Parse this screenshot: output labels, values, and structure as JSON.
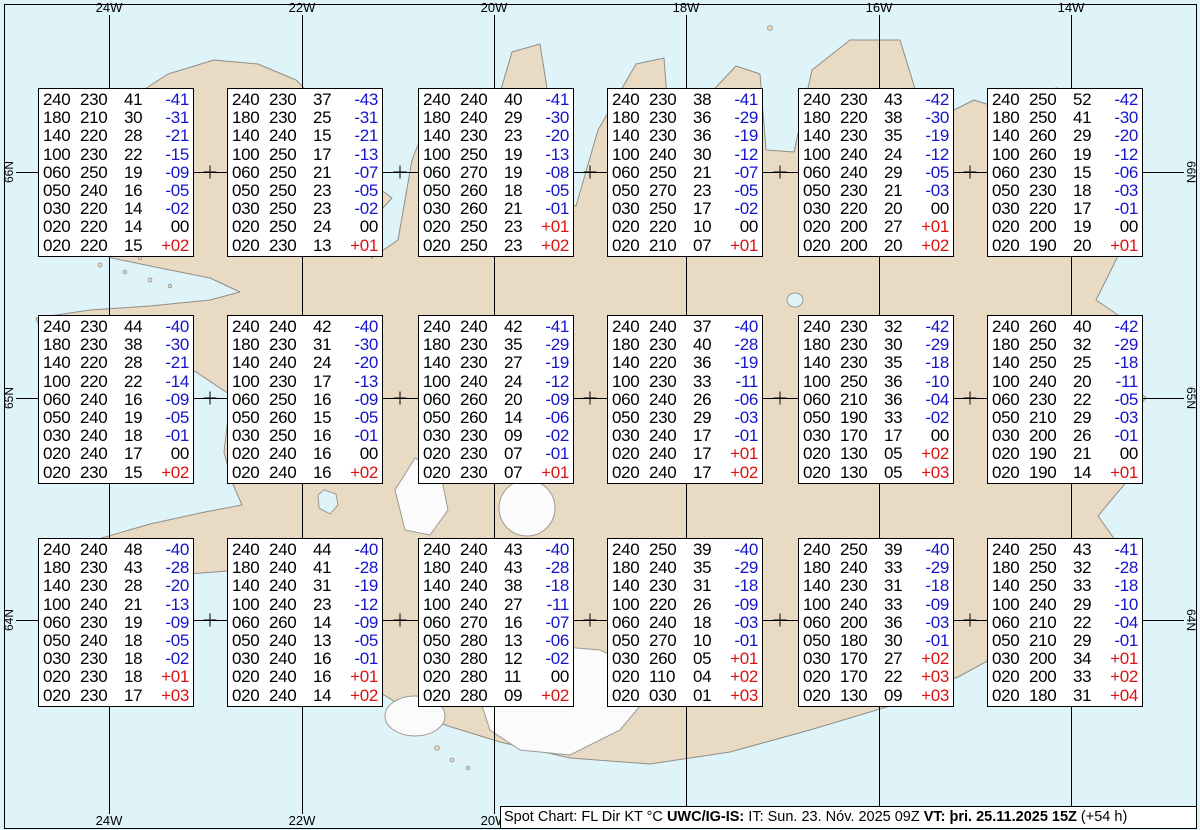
{
  "map": {
    "top_labels": [
      "24W",
      "22W",
      "20W",
      "18W",
      "16W",
      "14W"
    ],
    "bottom_labels": [
      "24W",
      "22W",
      "20W",
      "18W",
      "16W",
      "14W"
    ],
    "left_labels": [
      "66N",
      "65N",
      "64N"
    ],
    "right_labels": [
      "66N",
      "65N",
      "64N"
    ]
  },
  "colors": {
    "sea": "#dff4f9",
    "land": "#e9dac4",
    "coastline": "#8f8f88",
    "glacier": "#fbfbfb",
    "grid": "#000000",
    "box_background": "#ffffff",
    "temp_negative": "#1414cc",
    "temp_positive": "#dd1111",
    "text": "#000000"
  },
  "spots": [
    {
      "rows": [
        [
          "240",
          "230",
          "41",
          "-41"
        ],
        [
          "180",
          "210",
          "30",
          "-31"
        ],
        [
          "140",
          "220",
          "28",
          "-21"
        ],
        [
          "100",
          "230",
          "22",
          "-15"
        ],
        [
          "060",
          "250",
          "19",
          "-09"
        ],
        [
          "050",
          "240",
          "16",
          "-05"
        ],
        [
          "030",
          "220",
          "14",
          "-02"
        ],
        [
          "020",
          "220",
          "14",
          "00"
        ],
        [
          "020",
          "220",
          "15",
          "+02"
        ]
      ]
    },
    {
      "rows": [
        [
          "240",
          "230",
          "37",
          "-43"
        ],
        [
          "180",
          "230",
          "25",
          "-31"
        ],
        [
          "140",
          "240",
          "15",
          "-21"
        ],
        [
          "100",
          "250",
          "17",
          "-13"
        ],
        [
          "060",
          "250",
          "21",
          "-07"
        ],
        [
          "050",
          "250",
          "23",
          "-05"
        ],
        [
          "030",
          "250",
          "23",
          "-02"
        ],
        [
          "020",
          "250",
          "24",
          "00"
        ],
        [
          "020",
          "230",
          "13",
          "+01"
        ]
      ]
    },
    {
      "rows": [
        [
          "240",
          "240",
          "40",
          "-41"
        ],
        [
          "180",
          "240",
          "29",
          "-30"
        ],
        [
          "140",
          "230",
          "23",
          "-20"
        ],
        [
          "100",
          "250",
          "19",
          "-13"
        ],
        [
          "060",
          "270",
          "19",
          "-08"
        ],
        [
          "050",
          "260",
          "18",
          "-05"
        ],
        [
          "030",
          "260",
          "21",
          "-01"
        ],
        [
          "020",
          "250",
          "23",
          "+01"
        ],
        [
          "020",
          "250",
          "23",
          "+02"
        ]
      ]
    },
    {
      "rows": [
        [
          "240",
          "230",
          "38",
          "-41"
        ],
        [
          "180",
          "230",
          "36",
          "-29"
        ],
        [
          "140",
          "230",
          "36",
          "-19"
        ],
        [
          "100",
          "240",
          "30",
          "-12"
        ],
        [
          "060",
          "250",
          "21",
          "-07"
        ],
        [
          "050",
          "270",
          "23",
          "-05"
        ],
        [
          "030",
          "250",
          "17",
          "-02"
        ],
        [
          "020",
          "220",
          "10",
          "00"
        ],
        [
          "020",
          "210",
          "07",
          "+01"
        ]
      ]
    },
    {
      "rows": [
        [
          "240",
          "230",
          "43",
          "-42"
        ],
        [
          "180",
          "220",
          "38",
          "-30"
        ],
        [
          "140",
          "230",
          "35",
          "-19"
        ],
        [
          "100",
          "240",
          "24",
          "-12"
        ],
        [
          "060",
          "240",
          "29",
          "-05"
        ],
        [
          "050",
          "230",
          "21",
          "-03"
        ],
        [
          "030",
          "220",
          "20",
          "00"
        ],
        [
          "020",
          "200",
          "27",
          "+01"
        ],
        [
          "020",
          "200",
          "20",
          "+02"
        ]
      ]
    },
    {
      "rows": [
        [
          "240",
          "250",
          "52",
          "-42"
        ],
        [
          "180",
          "250",
          "41",
          "-30"
        ],
        [
          "140",
          "260",
          "29",
          "-20"
        ],
        [
          "100",
          "260",
          "19",
          "-12"
        ],
        [
          "060",
          "230",
          "15",
          "-06"
        ],
        [
          "050",
          "230",
          "18",
          "-03"
        ],
        [
          "030",
          "220",
          "17",
          "-01"
        ],
        [
          "020",
          "200",
          "19",
          "00"
        ],
        [
          "020",
          "190",
          "20",
          "+01"
        ]
      ]
    },
    {
      "rows": [
        [
          "240",
          "230",
          "44",
          "-40"
        ],
        [
          "180",
          "230",
          "38",
          "-30"
        ],
        [
          "140",
          "220",
          "28",
          "-21"
        ],
        [
          "100",
          "220",
          "22",
          "-14"
        ],
        [
          "060",
          "240",
          "16",
          "-09"
        ],
        [
          "050",
          "240",
          "19",
          "-05"
        ],
        [
          "030",
          "240",
          "18",
          "-01"
        ],
        [
          "020",
          "240",
          "17",
          "00"
        ],
        [
          "020",
          "230",
          "15",
          "+02"
        ]
      ]
    },
    {
      "rows": [
        [
          "240",
          "240",
          "42",
          "-40"
        ],
        [
          "180",
          "230",
          "31",
          "-30"
        ],
        [
          "140",
          "240",
          "24",
          "-20"
        ],
        [
          "100",
          "230",
          "17",
          "-13"
        ],
        [
          "060",
          "250",
          "16",
          "-09"
        ],
        [
          "050",
          "260",
          "15",
          "-05"
        ],
        [
          "030",
          "250",
          "16",
          "-01"
        ],
        [
          "020",
          "240",
          "16",
          "00"
        ],
        [
          "020",
          "240",
          "16",
          "+02"
        ]
      ]
    },
    {
      "rows": [
        [
          "240",
          "240",
          "42",
          "-41"
        ],
        [
          "180",
          "230",
          "35",
          "-29"
        ],
        [
          "140",
          "230",
          "27",
          "-19"
        ],
        [
          "100",
          "240",
          "24",
          "-12"
        ],
        [
          "060",
          "260",
          "20",
          "-09"
        ],
        [
          "050",
          "260",
          "14",
          "-06"
        ],
        [
          "030",
          "230",
          "09",
          "-02"
        ],
        [
          "020",
          "230",
          "07",
          "-01"
        ],
        [
          "020",
          "230",
          "07",
          "+01"
        ]
      ]
    },
    {
      "rows": [
        [
          "240",
          "240",
          "37",
          "-40"
        ],
        [
          "180",
          "230",
          "40",
          "-28"
        ],
        [
          "140",
          "220",
          "36",
          "-19"
        ],
        [
          "100",
          "230",
          "33",
          "-11"
        ],
        [
          "060",
          "240",
          "26",
          "-06"
        ],
        [
          "050",
          "230",
          "29",
          "-03"
        ],
        [
          "030",
          "240",
          "17",
          "-01"
        ],
        [
          "020",
          "240",
          "17",
          "+01"
        ],
        [
          "020",
          "240",
          "17",
          "+02"
        ]
      ]
    },
    {
      "rows": [
        [
          "240",
          "230",
          "32",
          "-42"
        ],
        [
          "180",
          "230",
          "30",
          "-29"
        ],
        [
          "140",
          "230",
          "35",
          "-18"
        ],
        [
          "100",
          "250",
          "36",
          "-10"
        ],
        [
          "060",
          "210",
          "36",
          "-04"
        ],
        [
          "050",
          "190",
          "33",
          "-02"
        ],
        [
          "030",
          "170",
          "17",
          "00"
        ],
        [
          "020",
          "130",
          "05",
          "+02"
        ],
        [
          "020",
          "130",
          "05",
          "+03"
        ]
      ]
    },
    {
      "rows": [
        [
          "240",
          "260",
          "40",
          "-42"
        ],
        [
          "180",
          "250",
          "32",
          "-29"
        ],
        [
          "140",
          "250",
          "25",
          "-18"
        ],
        [
          "100",
          "240",
          "20",
          "-11"
        ],
        [
          "060",
          "230",
          "22",
          "-05"
        ],
        [
          "050",
          "210",
          "29",
          "-03"
        ],
        [
          "030",
          "200",
          "26",
          "-01"
        ],
        [
          "020",
          "190",
          "21",
          "00"
        ],
        [
          "020",
          "190",
          "14",
          "+01"
        ]
      ]
    },
    {
      "rows": [
        [
          "240",
          "240",
          "48",
          "-40"
        ],
        [
          "180",
          "230",
          "43",
          "-28"
        ],
        [
          "140",
          "230",
          "28",
          "-20"
        ],
        [
          "100",
          "240",
          "21",
          "-13"
        ],
        [
          "060",
          "230",
          "19",
          "-09"
        ],
        [
          "050",
          "240",
          "18",
          "-05"
        ],
        [
          "030",
          "230",
          "18",
          "-02"
        ],
        [
          "020",
          "230",
          "18",
          "+01"
        ],
        [
          "020",
          "230",
          "17",
          "+03"
        ]
      ]
    },
    {
      "rows": [
        [
          "240",
          "240",
          "44",
          "-40"
        ],
        [
          "180",
          "240",
          "41",
          "-28"
        ],
        [
          "140",
          "240",
          "31",
          "-19"
        ],
        [
          "100",
          "240",
          "23",
          "-12"
        ],
        [
          "060",
          "260",
          "14",
          "-09"
        ],
        [
          "050",
          "240",
          "13",
          "-05"
        ],
        [
          "030",
          "240",
          "16",
          "-01"
        ],
        [
          "020",
          "240",
          "16",
          "+01"
        ],
        [
          "020",
          "240",
          "14",
          "+02"
        ]
      ]
    },
    {
      "rows": [
        [
          "240",
          "240",
          "43",
          "-40"
        ],
        [
          "180",
          "240",
          "43",
          "-28"
        ],
        [
          "140",
          "240",
          "38",
          "-18"
        ],
        [
          "100",
          "240",
          "27",
          "-11"
        ],
        [
          "060",
          "270",
          "16",
          "-07"
        ],
        [
          "050",
          "280",
          "13",
          "-06"
        ],
        [
          "030",
          "280",
          "12",
          "-02"
        ],
        [
          "020",
          "280",
          "11",
          "00"
        ],
        [
          "020",
          "280",
          "09",
          "+02"
        ]
      ]
    },
    {
      "rows": [
        [
          "240",
          "250",
          "39",
          "-40"
        ],
        [
          "180",
          "240",
          "35",
          "-29"
        ],
        [
          "140",
          "230",
          "31",
          "-18"
        ],
        [
          "100",
          "220",
          "26",
          "-09"
        ],
        [
          "060",
          "240",
          "18",
          "-03"
        ],
        [
          "050",
          "270",
          "10",
          "-01"
        ],
        [
          "030",
          "260",
          "05",
          "+01"
        ],
        [
          "020",
          "110",
          "04",
          "+02"
        ],
        [
          "020",
          "030",
          "01",
          "+03"
        ]
      ]
    },
    {
      "rows": [
        [
          "240",
          "250",
          "39",
          "-40"
        ],
        [
          "180",
          "240",
          "33",
          "-29"
        ],
        [
          "140",
          "230",
          "31",
          "-18"
        ],
        [
          "100",
          "240",
          "33",
          "-09"
        ],
        [
          "060",
          "200",
          "36",
          "-03"
        ],
        [
          "050",
          "180",
          "30",
          "-01"
        ],
        [
          "030",
          "170",
          "27",
          "+02"
        ],
        [
          "020",
          "170",
          "22",
          "+03"
        ],
        [
          "020",
          "130",
          "09",
          "+03"
        ]
      ]
    },
    {
      "rows": [
        [
          "240",
          "250",
          "43",
          "-41"
        ],
        [
          "180",
          "250",
          "32",
          "-28"
        ],
        [
          "140",
          "250",
          "33",
          "-18"
        ],
        [
          "100",
          "240",
          "29",
          "-10"
        ],
        [
          "060",
          "210",
          "22",
          "-04"
        ],
        [
          "050",
          "210",
          "29",
          "-01"
        ],
        [
          "030",
          "200",
          "34",
          "+01"
        ],
        [
          "020",
          "200",
          "33",
          "+02"
        ],
        [
          "020",
          "180",
          "31",
          "+04"
        ]
      ]
    }
  ],
  "footer": {
    "segments": [
      {
        "text": "Spot Chart: FL Dir KT °C ",
        "bold": false
      },
      {
        "text": "UWC/IG-IS:",
        "bold": true
      },
      {
        "text": " IT: Sun. 23. Nóv. 2025 09Z ",
        "bold": false
      },
      {
        "text": "VT: þri. 25.11.2025 15Z",
        "bold": true
      },
      {
        "text": " (+54 h)",
        "bold": false
      }
    ]
  }
}
